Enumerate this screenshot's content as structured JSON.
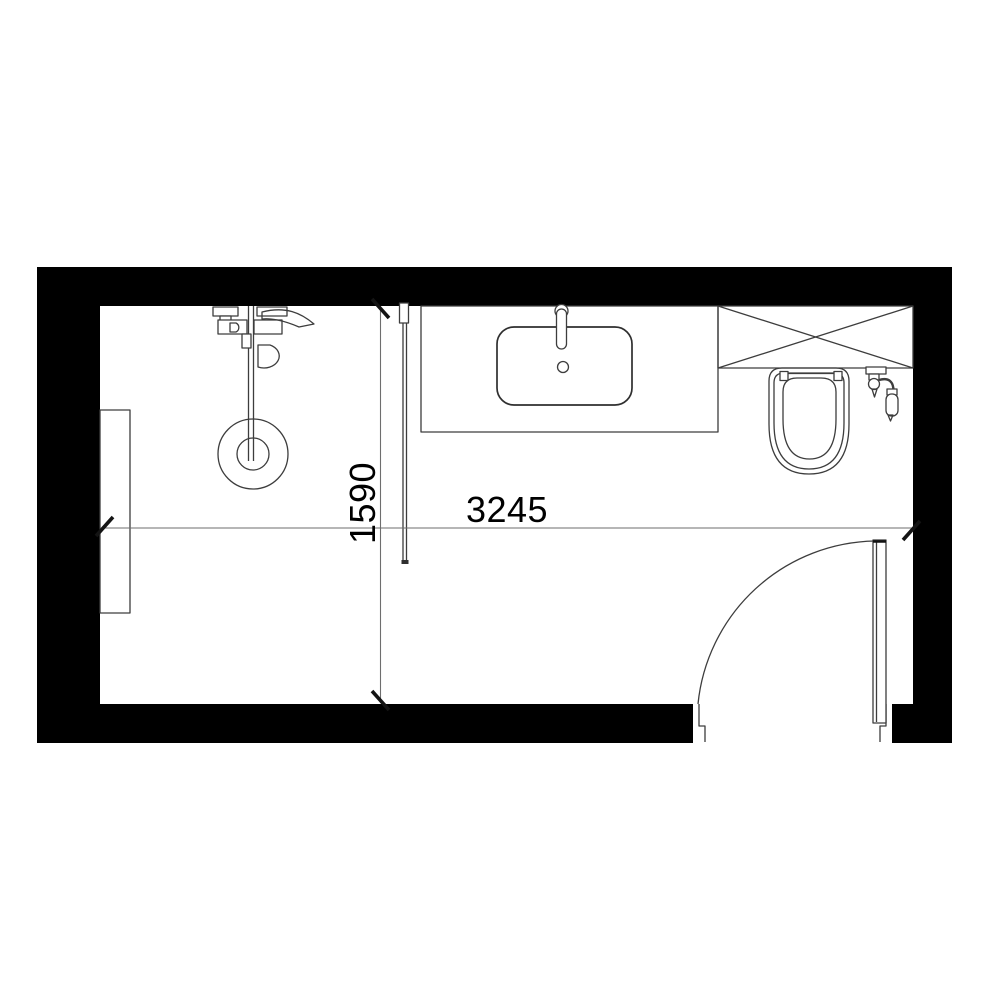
{
  "plan": {
    "dimensions": {
      "horizontal": {
        "label": "3245",
        "value_mm": 3245
      },
      "vertical": {
        "label": "1590",
        "value_mm": 1590
      }
    },
    "colors": {
      "background": "#ffffff",
      "wall": "#000000",
      "fixture_line": "#3d3d3d",
      "dimension_line": "#6e6e6e",
      "tick": "#141414",
      "text": "#000000"
    },
    "fixtures": {
      "shower": "shower-mixer-with-drain",
      "glass_partition": "shower-glass-screen",
      "vanity": "vanity-counter-with-basin",
      "crossed_box": "appliance-niche-crossed",
      "toilet": "wall-hung-toilet",
      "sprayer": "hand-sprayer",
      "wall_recess": "wall-recess",
      "door": "swing-door"
    }
  }
}
